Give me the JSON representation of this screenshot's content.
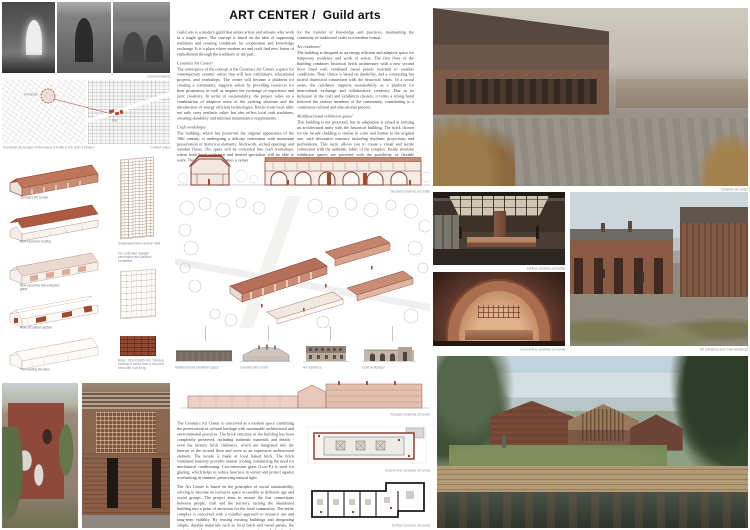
{
  "header": {
    "title_main": "ART CENTER /",
    "title_sub": "Guild arts"
  },
  "site": {
    "photos_caption": "Current situation",
    "map_city_label": "Kronstadt",
    "map_site_label": "Site",
    "maps_caption": "Kronstadt city located on the island of Kotlin in the Gulf of Finland",
    "maps_caption_right": "Context plans"
  },
  "intro": {
    "col1": {
      "p1": "Guild arts is a modern guild that unites artists and artisans who work in a single space. The concept is based on the idea of supporting traditions and creating conditions for cooperation and knowledge exchange. It is a place where modern art and craft find new forms of embodiment through the traditions of the past.",
      "h1": "Ceramics Art Center/",
      "p2": "The centerpiece of the concept is the Ceramics Art Center, a space for contemporary ceramic artists that will host exhibitions, educational projects, and workshops. The center will become a platform for creating a community, supports artists by providing resources for their promotion, as well as inspires the exchange of experience and joint creativity. In terms of sustainability, the project relies on a combination of adaptive reuse of the existing structure and the introduction of energy efficient technologies. Bricks from local kilns not only carry aesthetic value, but also reflect local craft traditions, ensuring durability and minimal maintenance requirements.",
      "h2": "Craft workshops/",
      "p3": "The building, which has preserved the original appearance of the 19th century, is undergoing a delicate restoration with maximum preservation of historical elements: brickwork, arched openings and wooden floors. The space will be converted into craft workshops, where both local craftsmen and invited specialists will be able to work. Thus, the building becomes a center"
    },
    "col2": {
      "p1": "for the transfer of knowledge and practices, maintaining the continuity of traditional crafts in a modern format.",
      "h1": "Art residence/",
      "p2": "The building is designed as an energy efficient and adaptive space for temporary residence and work of artists. The first floor of the building combines historical brick architecture with a new second floor lined with ventilated metal panels resistant to weather conditions. Their choice is based on durability, and a contrasting but tactful dialectical connection with the historical fabric. In a social sense, the residence supports sustainability as a platform for intercultural exchange and collaborative creativity. Due to its inclusion in the craft and exhibition clusters, it forms a strong bond between the various members of the community, contributing to a continuous cultural and educational process.",
      "h2": "Multifunctional exhibition space/",
      "p3": "This building is not protected, but its adaptation is aimed at forming an architectural unity with the historical building. The brick chosen for the facade cladding is similar in color and format to the original one, with decorative masonry including rhythmic projections and perforations. This tactic allows you to create a visual and tactile connection with the authentic fabric of the complex. Inside, modular exhibition spaces are provided with the possibility of flexible transformation."
    }
  },
  "sections": {
    "caption": "Sections ceramics art center"
  },
  "elevations": {
    "items": [
      {
        "label": "Multifunctional exhibition space"
      },
      {
        "label": "Ceramics Art Center"
      },
      {
        "label": "Art residence"
      },
      {
        "label": "Craft workshops"
      }
    ]
  },
  "diagrams": {
    "steps": [
      {
        "label": "Ceramics Art Center"
      },
      {
        "label": "New structure/ roofing"
      },
      {
        "label": "New structure/ low-emission glass"
      },
      {
        "label": "New circulation system"
      },
      {
        "label": "The existing structure"
      }
    ],
    "screen_wall_title": "Sustainable Brick Screen Wall",
    "screen_wall_note": "For controlled daylight penetration and passive ventilation",
    "brick_note": "Brick / 250x120x65 mm / Manual forming of bricks from a recycled brick with coal firing"
  },
  "sustainability": {
    "p1": "The Ceramics Art Center is conceived as a modern space combining the preservation of cultural heritage with sustainable architectural and environmental practices. The brick structure of the building has been completely preserved, including authentic materials and details - even the historic brick chimneys, which are integrated into the interior of the second floor and serve as an expressive architectural element. The facade is made of local baked brick. The brick ventilated masonry provides natural cooling, minimizing the need for mechanical conditioning. Low-emission glass (Low-E) is used for glazing, which helps to reduce heat loss in winter and protect against overheating in summer, preserving natural light.",
    "p2": "The Art Center is based on the principles of social sustainability, striving to become an inclusive space accessible to different age and social groups. The project aims to restore the lost connections between people, craft and the territory, turning the abandoned building into a point of attraction for the local community. The entire complex is conceived with a mindful approach to resource use and long-term viability. By reusing existing buildings and integrating simple, durable materials such as local brick and metal panels, the project avoids excessive construction costs and limits the environmental footprint."
  },
  "plans": {
    "facade_caption": "Facades ceramics art center",
    "ground_caption": "Ground floor ceramics art center",
    "first_caption": "1st floor ceramics art center"
  },
  "renders": {
    "main_caption": "Ceramics art center",
    "interior1_caption": "1st floor ceramics art center",
    "interior2_caption": "Ground floor ceramics art center",
    "courtyard_caption": "Art residence and Craft workshops"
  },
  "colors": {
    "brick": "#9a4a32",
    "brick_light": "#c98d76",
    "accent_red": "#b0492f",
    "text": "#3d3d3d",
    "caption_gray": "#8c8c8c"
  }
}
